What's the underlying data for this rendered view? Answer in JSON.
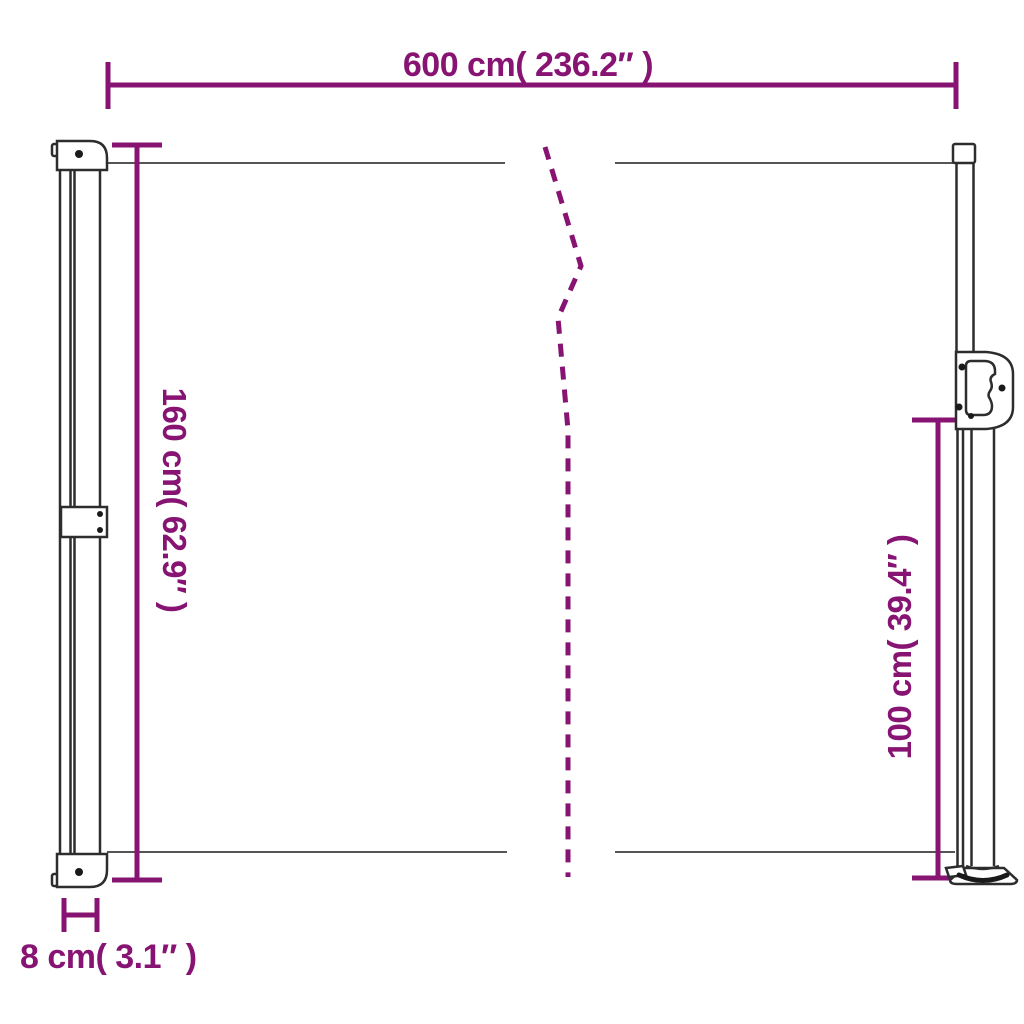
{
  "colors": {
    "dimension_accent": "#871472",
    "drawing_outline": "#2d2d2d",
    "background": "#ffffff"
  },
  "dimensions": {
    "width": {
      "label": "600 cm( 236.2″ )",
      "value_cm": 600,
      "value_in": 236.2
    },
    "height_left": {
      "label": "160 cm( 62.9″ )",
      "value_cm": 160,
      "value_in": 62.9
    },
    "height_right": {
      "label": "100 cm( 39.4″ )",
      "value_cm": 100,
      "value_in": 39.4
    },
    "depth": {
      "label": "8 cm( 3.1″ )",
      "value_cm": 8,
      "value_in": 3.1
    }
  }
}
